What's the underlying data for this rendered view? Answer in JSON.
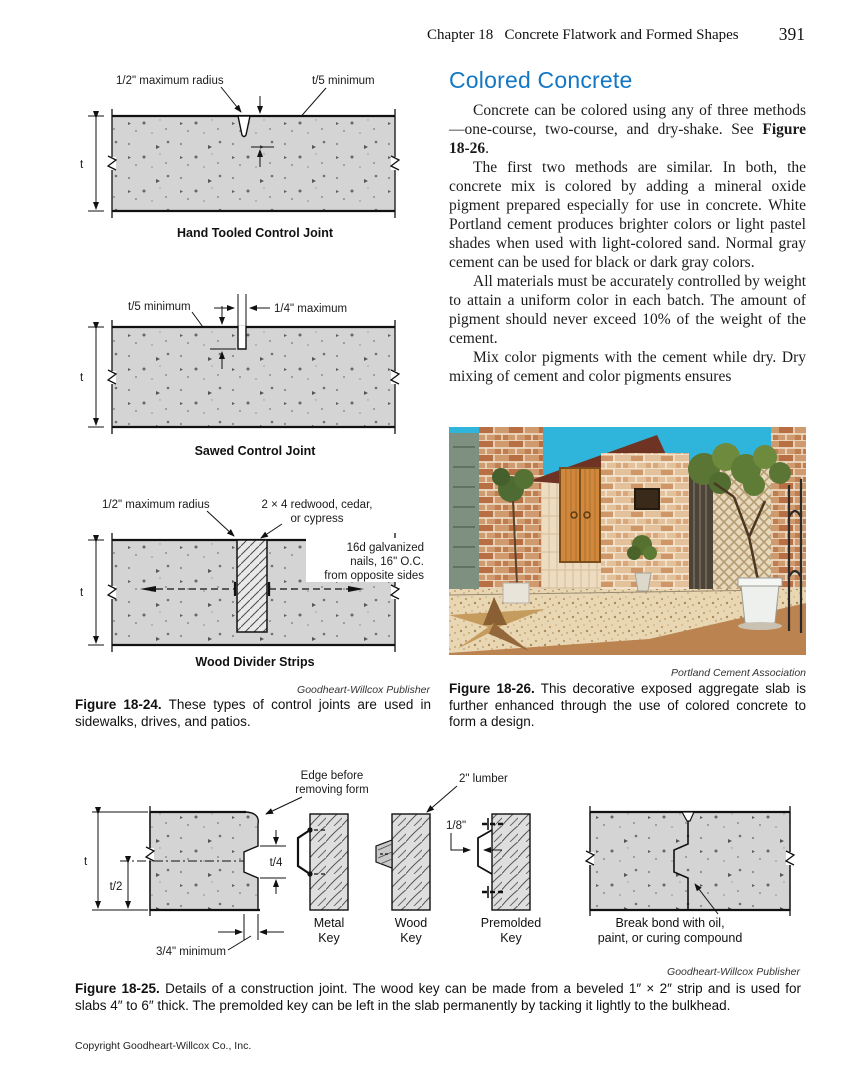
{
  "header": {
    "chapter": "Chapter 18   Concrete Flatwork and Formed Shapes",
    "page_number": "391"
  },
  "colors": {
    "heading_blue": "#1377c4",
    "concrete_gray": "#d4d4d4"
  },
  "figure_18_24": {
    "hand_tooled": {
      "label_radius": "1/2\" maximum radius",
      "label_depth": "t/5 minimum",
      "label_t": "t",
      "caption": "Hand Tooled Control Joint"
    },
    "sawed": {
      "label_depth": "t/5 minimum",
      "label_width": "1/4\" maximum",
      "label_t": "t",
      "caption": "Sawed Control Joint"
    },
    "wood_divider": {
      "label_radius": "1/2\" maximum radius",
      "label_wood_1": "2 × 4 redwood, cedar,",
      "label_wood_2": "or cypress",
      "label_nails_1": "16d galvanized",
      "label_nails_2": "nails, 16\" O.C.",
      "label_nails_3": "from opposite sides",
      "label_t": "t",
      "caption": "Wood Divider Strips"
    },
    "credit": "Goodheart-Willcox Publisher",
    "caption_label": "Figure 18-24.",
    "caption_text": " These types of control joints are used in sidewalks, drives, and patios."
  },
  "article": {
    "title": "Colored Concrete",
    "p1_pre": "Concrete can be colored using any of three methods—one-course, two-course, and dry-shake. See ",
    "p1_ref": "Figure 18-26",
    "p1_post": ".",
    "p2": "The first two methods are similar. In both, the concrete mix is colored by adding a mineral oxide pigment prepared especially for use in concrete. White Portland cement produces brighter colors or light pastel shades when used with light-colored sand. Normal gray cement can be used for black or dark gray colors.",
    "p3": "All materials must be accurately controlled by weight to attain a uniform color in each batch. The amount of pigment should never exceed 10% of the weight of the cement.",
    "p4": "Mix color pigments with the cement while dry. Dry mixing of cement and color pigments ensures"
  },
  "figure_18_26": {
    "credit": "Portland Cement Association",
    "caption_label": "Figure 18-26.",
    "caption_text": " This decorative exposed aggregate slab is further enhanced through the use of colored concrete to form a design."
  },
  "figure_18_25": {
    "label_edge_1": "Edge before",
    "label_edge_2": "removing form",
    "label_lumber": "2\" lumber",
    "label_t": "t",
    "label_t2": "t/2",
    "label_t4": "t/4",
    "label_min": "3/4\" minimum",
    "label_eighth": "1/8\"",
    "caption_metal": "Metal Key",
    "caption_wood": "Wood Key",
    "caption_premolded": "Premolded Key",
    "caption_break_1": "Break bond with oil,",
    "caption_break_2": "paint, or curing compound",
    "credit": "Goodheart-Willcox Publisher",
    "caption_label": "Figure 18-25.",
    "caption_text": " Details of a construction joint. The wood key can be made from a beveled 1″ × 2″ strip and is used for slabs 4″ to 6″ thick. The premolded key can be left in the slab permanently by tacking it lightly to the bulkhead."
  },
  "footer": {
    "copyright": "Copyright Goodheart-Willcox Co., Inc."
  }
}
